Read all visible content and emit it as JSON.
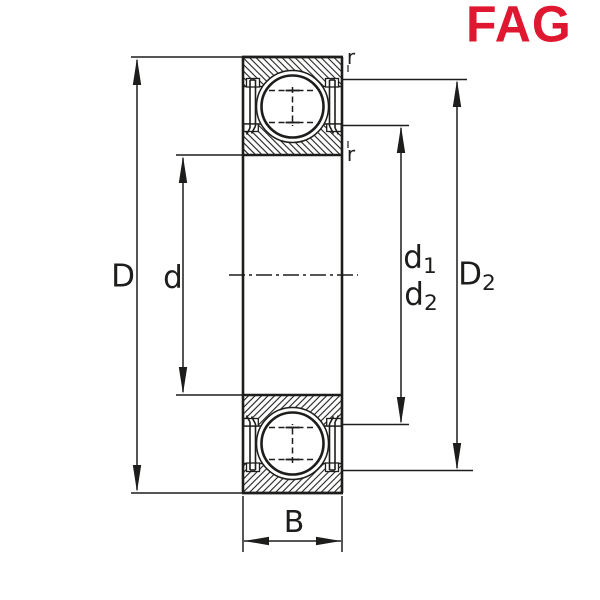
{
  "logo": {
    "text": "FAG",
    "color": "#E01730"
  },
  "drawing": {
    "line_color": "#1d1d1b",
    "type_description": "bearing cross-section",
    "labels": {
      "outer_diameter": "D",
      "bore_diameter": "d",
      "d1": {
        "base": "d",
        "sub": "1"
      },
      "d2": {
        "base": "d",
        "sub": "2"
      },
      "D2": {
        "base": "D",
        "sub": "2"
      },
      "width": "B",
      "chamfer_top": "r",
      "chamfer_bottom": "r"
    }
  }
}
